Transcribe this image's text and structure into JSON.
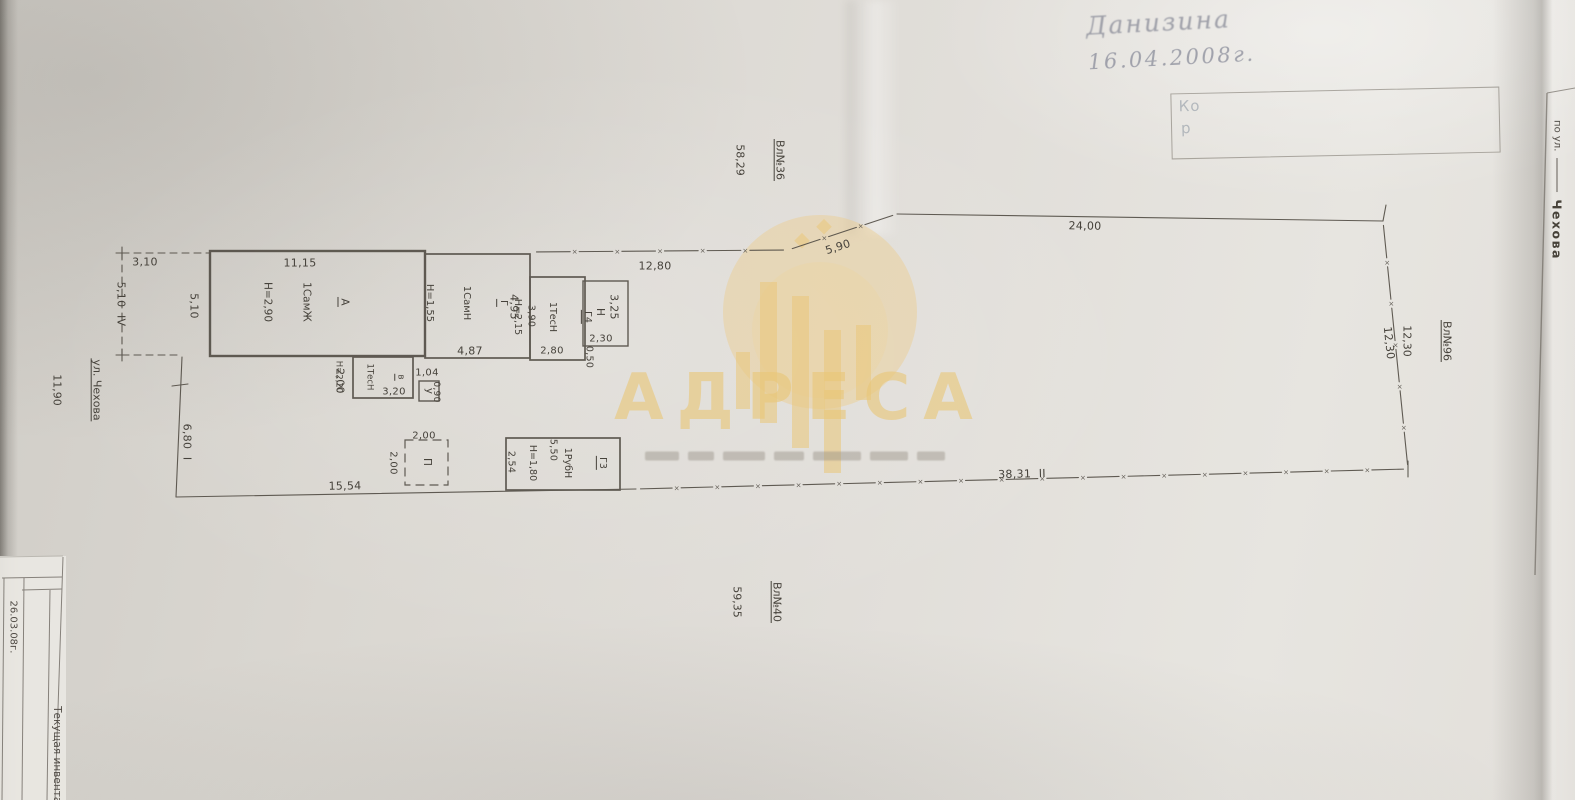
{
  "colors": {
    "ink": "#4a453e",
    "paper": "#dfdcd6",
    "watermark_gold": "#e9c678"
  },
  "watermark": {
    "brand": "АДРЕСА"
  },
  "handwriting": {
    "signature": "Данизина",
    "date": "16.04.2008г."
  },
  "stamp": {
    "line1": "Ко",
    "line2": "р"
  },
  "side_page": {
    "prefix": "по ул.",
    "street": "Чехова"
  },
  "title_block": {
    "date": "26.03.08г.",
    "label": "Текущая инвентар"
  },
  "plan": {
    "street": {
      "name": "ул. Чехова",
      "frontage": "11,90"
    },
    "neighbors": {
      "top": {
        "label": "Вл№36",
        "length": "58,29"
      },
      "right": {
        "label": "Вл№96",
        "length": "12,30"
      },
      "bottom": {
        "label": "Вл№40",
        "length": "59,35"
      }
    },
    "dims": {
      "d310": "3,10",
      "d510iv": "5,10  IV",
      "d680i": "6,80  I",
      "d1280": "12,80",
      "d590": "5,90",
      "d2400": "24,00",
      "d1230": "12,30",
      "d3831": "38,31  II",
      "d1554": "15,54"
    },
    "buildings": {
      "A": {
        "letter": "А",
        "type": "1СамЖ",
        "height": "Н=2,90",
        "width": "11,15",
        "depth": "5,10"
      },
      "G": {
        "letter": "Г",
        "type": "1СамН",
        "height": "Н=1,55",
        "width": "4,87",
        "depth": "4,95"
      },
      "G4": {
        "letter": "Г4",
        "type": "1ТесН",
        "height": "Н=2,15",
        "width": "2,80",
        "depth": "3,90"
      },
      "N": {
        "letter": "Н",
        "width": "2,30",
        "depth": "3,25",
        "offset": "0,50"
      },
      "v": {
        "letter": "в",
        "type": "1ТесН",
        "height": "Н=2,20",
        "width": "3,20",
        "depth": "2,00"
      },
      "u": {
        "letter": "у",
        "width": "1,04",
        "depth": "0,90"
      },
      "P": {
        "letter": "П",
        "width": "2,00",
        "depth": "2,00"
      },
      "G3": {
        "letter": "Г3",
        "type": "1РубН",
        "height": "Н=1,80",
        "width": "5,50",
        "depth": "2,54"
      }
    }
  }
}
